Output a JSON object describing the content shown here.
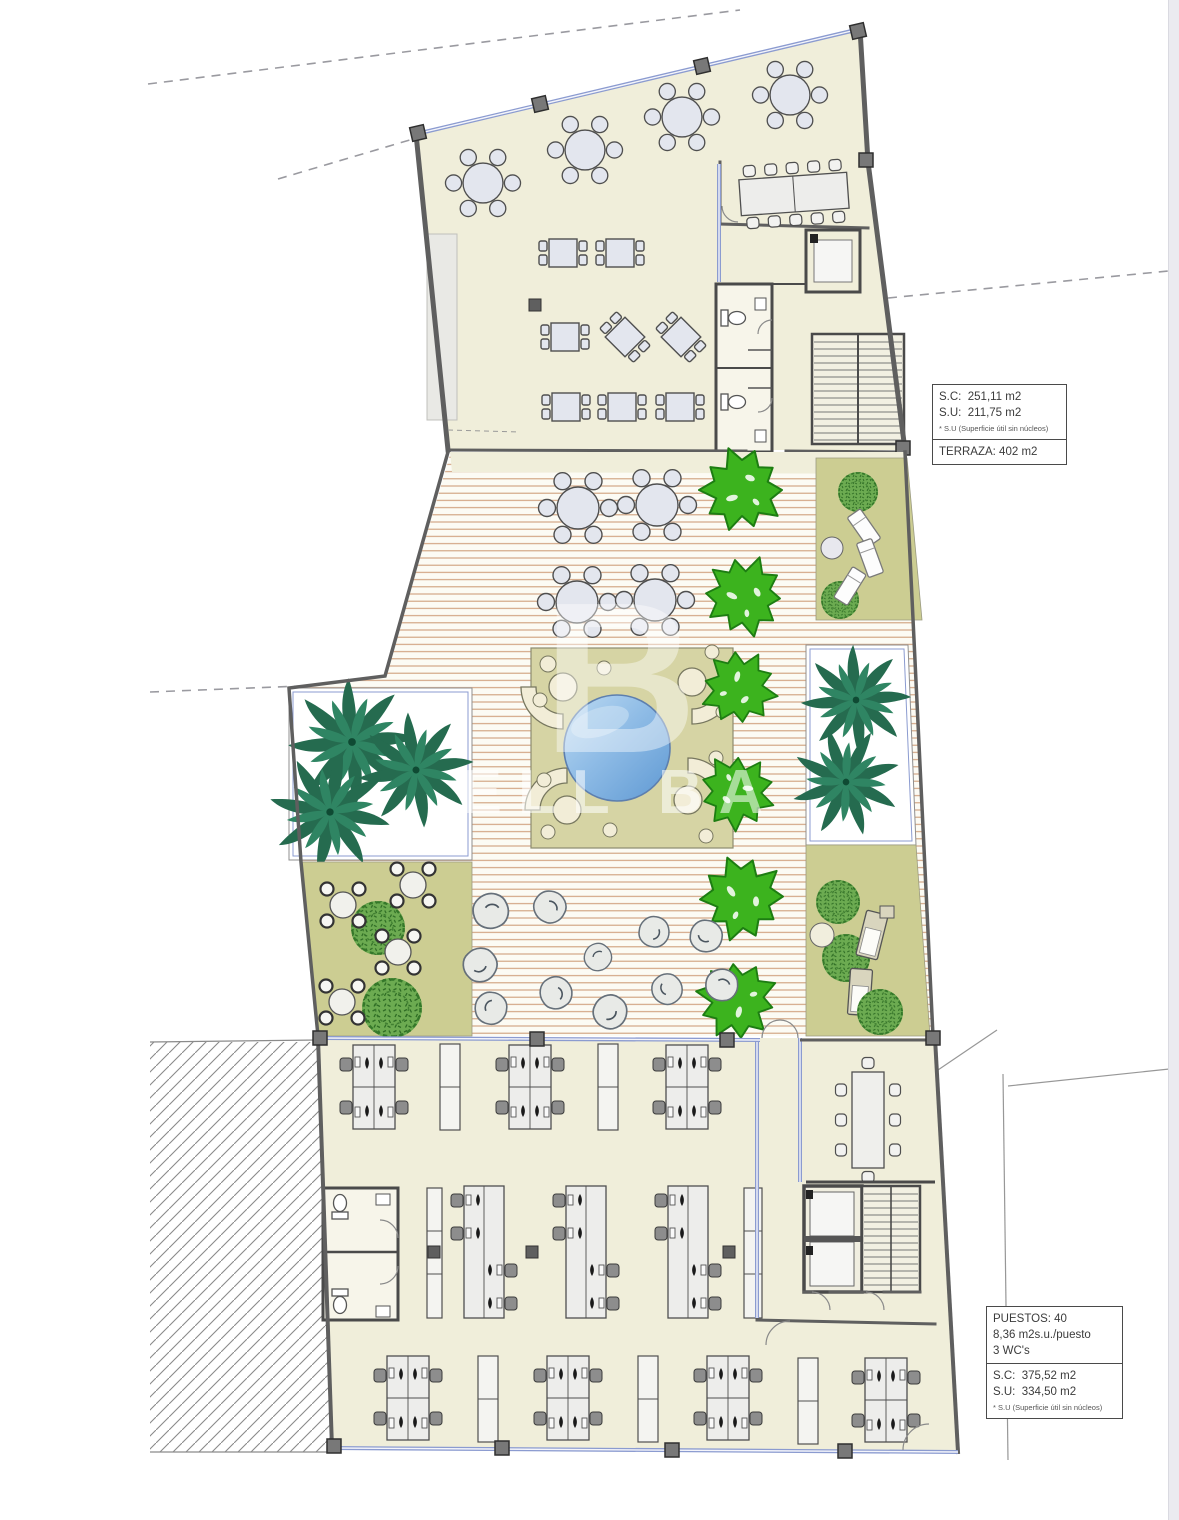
{
  "annotations": {
    "upper_box": {
      "sc": "S.C:  251,11 m2",
      "su": "S.U:  211,75 m2",
      "note": "* S.U (Superficie útil sin núcleos)",
      "terraza": "TERRAZA: 402 m2"
    },
    "lower_box": {
      "puestos": "PUESTOS: 40",
      "ratio": "8,36 m2s.u./puesto",
      "wcs": "3 WC's",
      "sc": "S.C:  375,52 m2",
      "su": "S.U:  334,50 m2",
      "note": "* S.U (Superficie útil sin núcleos)"
    }
  },
  "watermark": {
    "monogram": "B",
    "text": "ELL BA"
  },
  "colors": {
    "floor": "#f0eeda",
    "olive": "#cccd92",
    "deck_line": "#cf9f7c",
    "pool": "#5f99d3",
    "tree": "#3cb31e",
    "glazing": "#8b9bd0"
  }
}
